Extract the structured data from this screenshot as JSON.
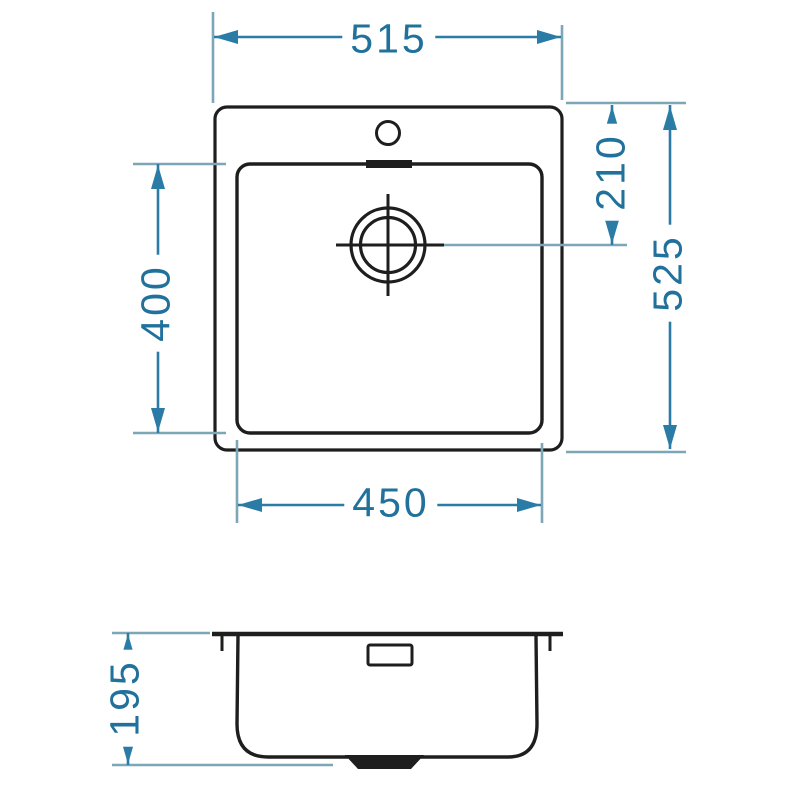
{
  "drawing": {
    "type": "technical-dimension-drawing",
    "subject": "square kitchen sink, top view and side section view"
  },
  "colors": {
    "dimension": "#2a7ba6",
    "extension": "#7da6b6",
    "label_text": "#20719b",
    "outline": "#1e1e1e",
    "background": "#ffffff"
  },
  "dimensions": {
    "overall_width": "515",
    "drain_center_from_top": "210",
    "overall_depth": "525",
    "bowl_front_to_back": "400",
    "bowl_width": "450",
    "bowl_height": "195"
  }
}
